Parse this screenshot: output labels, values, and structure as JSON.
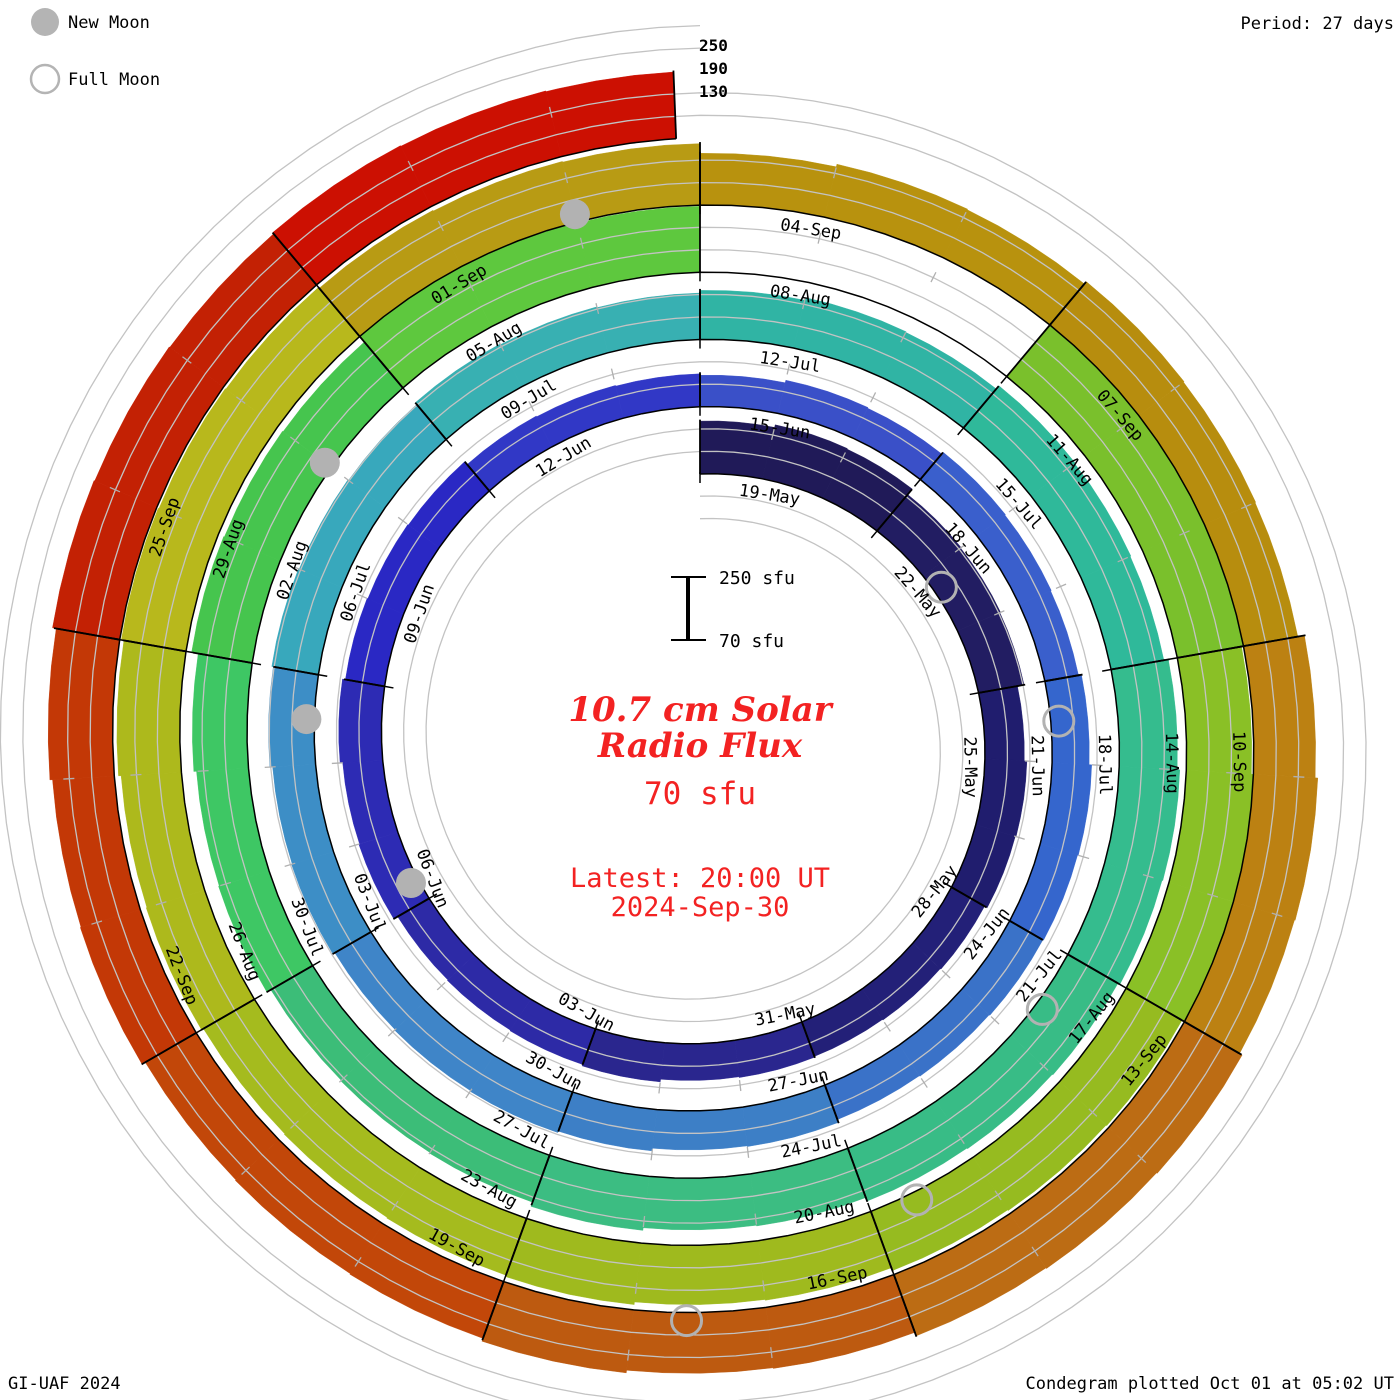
{
  "legend": {
    "new_moon": "New Moon",
    "full_moon": "Full Moon"
  },
  "period_label": "Period: 27 days",
  "radial_scale_labels": [
    "250",
    "190",
    "130"
  ],
  "center_scale": {
    "top": "250 sfu",
    "bottom": "70 sfu"
  },
  "center": {
    "title_line1": "10.7 cm Solar",
    "title_line2": "Radio Flux",
    "value": "70 sfu",
    "latest_line1": "Latest: 20:00 UT",
    "latest_line2": "2024-Sep-30"
  },
  "footer": {
    "left": "GI-UAF 2024",
    "right": "Condegram plotted Oct 01 at 05:02 UT"
  },
  "chart_data": {
    "type": "bar",
    "variant": "condegram-spiral",
    "title": "10.7 cm Solar Radio Flux",
    "period_days": 27,
    "segment_days": 3,
    "sfu_baseline": 70,
    "sfu_gridlines": [
      130,
      190,
      250
    ],
    "start_date": "19-May",
    "end_date": "30-Sep",
    "segments": [
      {
        "date": "19-May",
        "flux": 215,
        "color": "#201a58"
      },
      {
        "date": "22-May",
        "flux": 196,
        "color": "#221d62"
      },
      {
        "date": "25-May",
        "flux": 178,
        "color": "#201d6e"
      },
      {
        "date": "28-May",
        "flux": 170,
        "color": "#232078"
      },
      {
        "date": "31-May",
        "flux": 172,
        "color": "#2a268e"
      },
      {
        "date": "03-Jun",
        "flux": 168,
        "color": "#2d2aa6"
      },
      {
        "date": "06-Jun",
        "flux": 180,
        "color": "#2d2bb4"
      },
      {
        "date": "09-Jun",
        "flux": 172,
        "color": "#2a28c4"
      },
      {
        "date": "12-Jun",
        "flux": 162,
        "color": "#3138c6"
      },
      {
        "date": "15-Jun",
        "flux": 158,
        "color": "#3a50c8"
      },
      {
        "date": "18-Jun",
        "flux": 164,
        "color": "#3a5fcc"
      },
      {
        "date": "21-Jun",
        "flux": 172,
        "color": "#3566cd"
      },
      {
        "date": "24-Jun",
        "flux": 170,
        "color": "#3a72c8"
      },
      {
        "date": "27-Jun",
        "flux": 178,
        "color": "#3d7fc6"
      },
      {
        "date": "30-Jun",
        "flux": 182,
        "color": "#3f85c8"
      },
      {
        "date": "03-Jul",
        "flux": 188,
        "color": "#3d8ec6"
      },
      {
        "date": "06-Jul",
        "flux": 192,
        "color": "#38a8bc"
      },
      {
        "date": "09-Jul",
        "flux": 198,
        "color": "#38b0b2"
      },
      {
        "date": "12-Jul",
        "flux": 205,
        "color": "#30b4a4"
      },
      {
        "date": "15-Jul",
        "flux": 216,
        "color": "#2fb99a"
      },
      {
        "date": "18-Jul",
        "flux": 228,
        "color": "#35bc8e"
      },
      {
        "date": "21-Jul",
        "flux": 222,
        "color": "#38bc86"
      },
      {
        "date": "24-Jul",
        "flux": 212,
        "color": "#3cbd82"
      },
      {
        "date": "27-Jul",
        "flux": 200,
        "color": "#3cbd78"
      },
      {
        "date": "30-Jul",
        "flux": 212,
        "color": "#3ec764"
      },
      {
        "date": "02-Aug",
        "flux": 230,
        "color": "#46c54e"
      },
      {
        "date": "05-Aug",
        "flux": 250,
        "color": "#5ec83e"
      },
      {
        "date": "08-Aug",
        "flux": null,
        "color": "#ffffff"
      },
      {
        "date": "11-Aug",
        "flux": 252,
        "color": "#7ac02c"
      },
      {
        "date": "14-Aug",
        "flux": 247,
        "color": "#8ac026"
      },
      {
        "date": "17-Aug",
        "flux": 240,
        "color": "#96bb20"
      },
      {
        "date": "20-Aug",
        "flux": 232,
        "color": "#9fba1e"
      },
      {
        "date": "23-Aug",
        "flux": 228,
        "color": "#a5bb1e"
      },
      {
        "date": "26-Aug",
        "flux": 234,
        "color": "#adb91c"
      },
      {
        "date": "29-Aug",
        "flux": 241,
        "color": "#b8b81c"
      },
      {
        "date": "01-Sep",
        "flux": 238,
        "color": "#b89b14"
      },
      {
        "date": "04-Sep",
        "flux": 212,
        "color": "#b8920e"
      },
      {
        "date": "07-Sep",
        "flux": 220,
        "color": "#b78d0e"
      },
      {
        "date": "10-Sep",
        "flux": 238,
        "color": "#bc8112"
      },
      {
        "date": "13-Sep",
        "flux": 246,
        "color": "#bc6c14"
      },
      {
        "date": "16-Sep",
        "flux": 236,
        "color": "#bd5a10"
      },
      {
        "date": "19-Sep",
        "flux": 228,
        "color": "#c24709"
      },
      {
        "date": "22-Sep",
        "flux": 238,
        "color": "#c33806"
      },
      {
        "date": "25-Sep",
        "flux": 248,
        "color": "#c32104"
      },
      {
        "date": "28-Sep",
        "flux": 252,
        "color": "#cc1002",
        "no_label": true
      }
    ],
    "moons": {
      "new": [
        {
          "date": "06-Jun",
          "day": 18.3
        },
        {
          "date": "05-Jul",
          "day": 47.5
        },
        {
          "date": "04-Aug",
          "day": 77.0
        },
        {
          "date": "03-Sep",
          "day": 107.0
        }
      ],
      "full": [
        {
          "date": "23-May",
          "day": 4.3
        },
        {
          "date": "21-Jun",
          "day": 33.5
        },
        {
          "date": "21-Jul",
          "day": 63.6
        },
        {
          "date": "19-Aug",
          "day": 92.6
        },
        {
          "date": "17-Sep",
          "day": 121.6
        }
      ]
    }
  }
}
